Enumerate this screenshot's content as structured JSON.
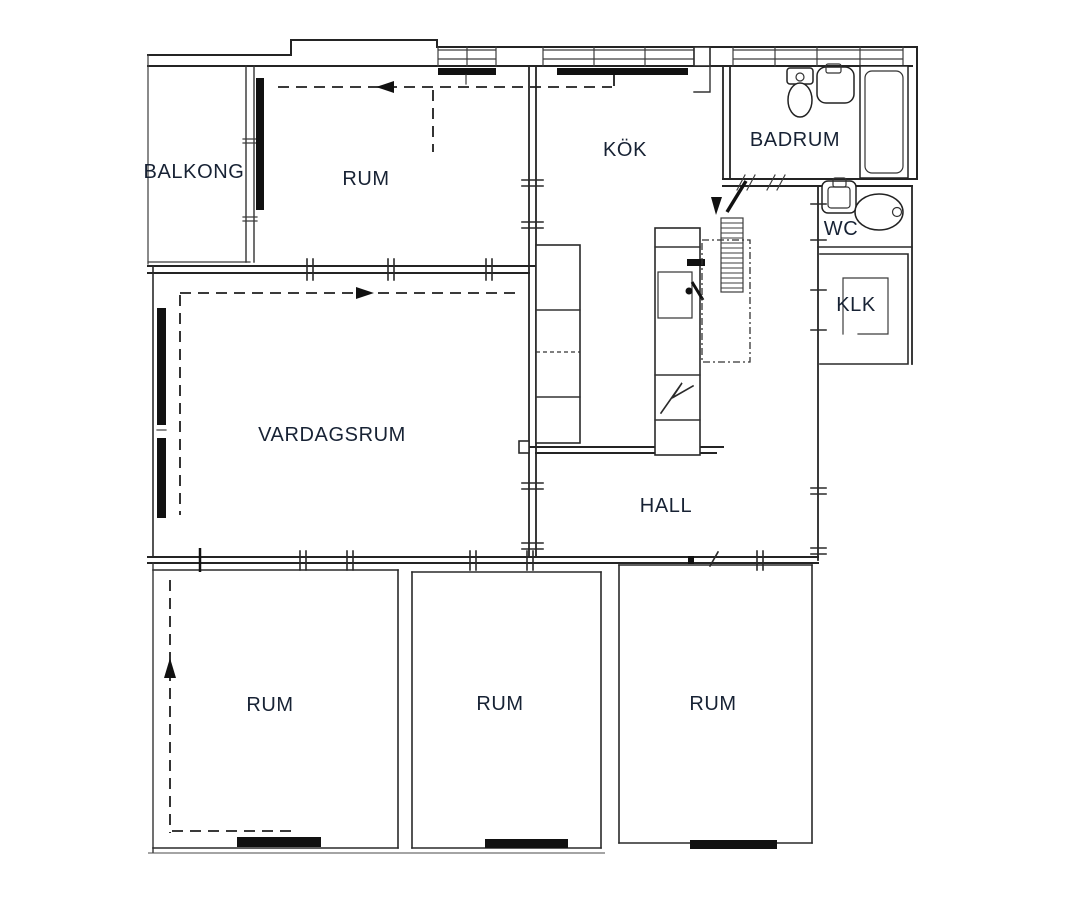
{
  "rooms": [
    {
      "id": "balkong",
      "label": "BALKONG"
    },
    {
      "id": "rum-top",
      "label": "RUM"
    },
    {
      "id": "kok",
      "label": "KÖK"
    },
    {
      "id": "badrum",
      "label": "BADRUM"
    },
    {
      "id": "wc",
      "label": "WC"
    },
    {
      "id": "klk",
      "label": "KLK"
    },
    {
      "id": "vardagsrum",
      "label": "VARDAGSRUM"
    },
    {
      "id": "hall",
      "label": "HALL"
    },
    {
      "id": "rum-bottom-left",
      "label": "RUM"
    },
    {
      "id": "rum-bottom-middle",
      "label": "RUM"
    },
    {
      "id": "rum-bottom-right",
      "label": "RUM"
    }
  ],
  "fixtures": [
    {
      "name": "bathtub"
    },
    {
      "name": "toilet-badrum"
    },
    {
      "name": "sink-badrum"
    },
    {
      "name": "toilet-wc"
    },
    {
      "name": "sink-wc"
    },
    {
      "name": "kitchen-counter"
    },
    {
      "name": "kitchen-tall-unit"
    },
    {
      "name": "stove"
    },
    {
      "name": "radiator"
    },
    {
      "name": "wardrobe-shelf"
    }
  ],
  "colors": {
    "background": "#ffffff",
    "line": "#242424",
    "text": "#172234",
    "fixture_fill": "#111111"
  }
}
